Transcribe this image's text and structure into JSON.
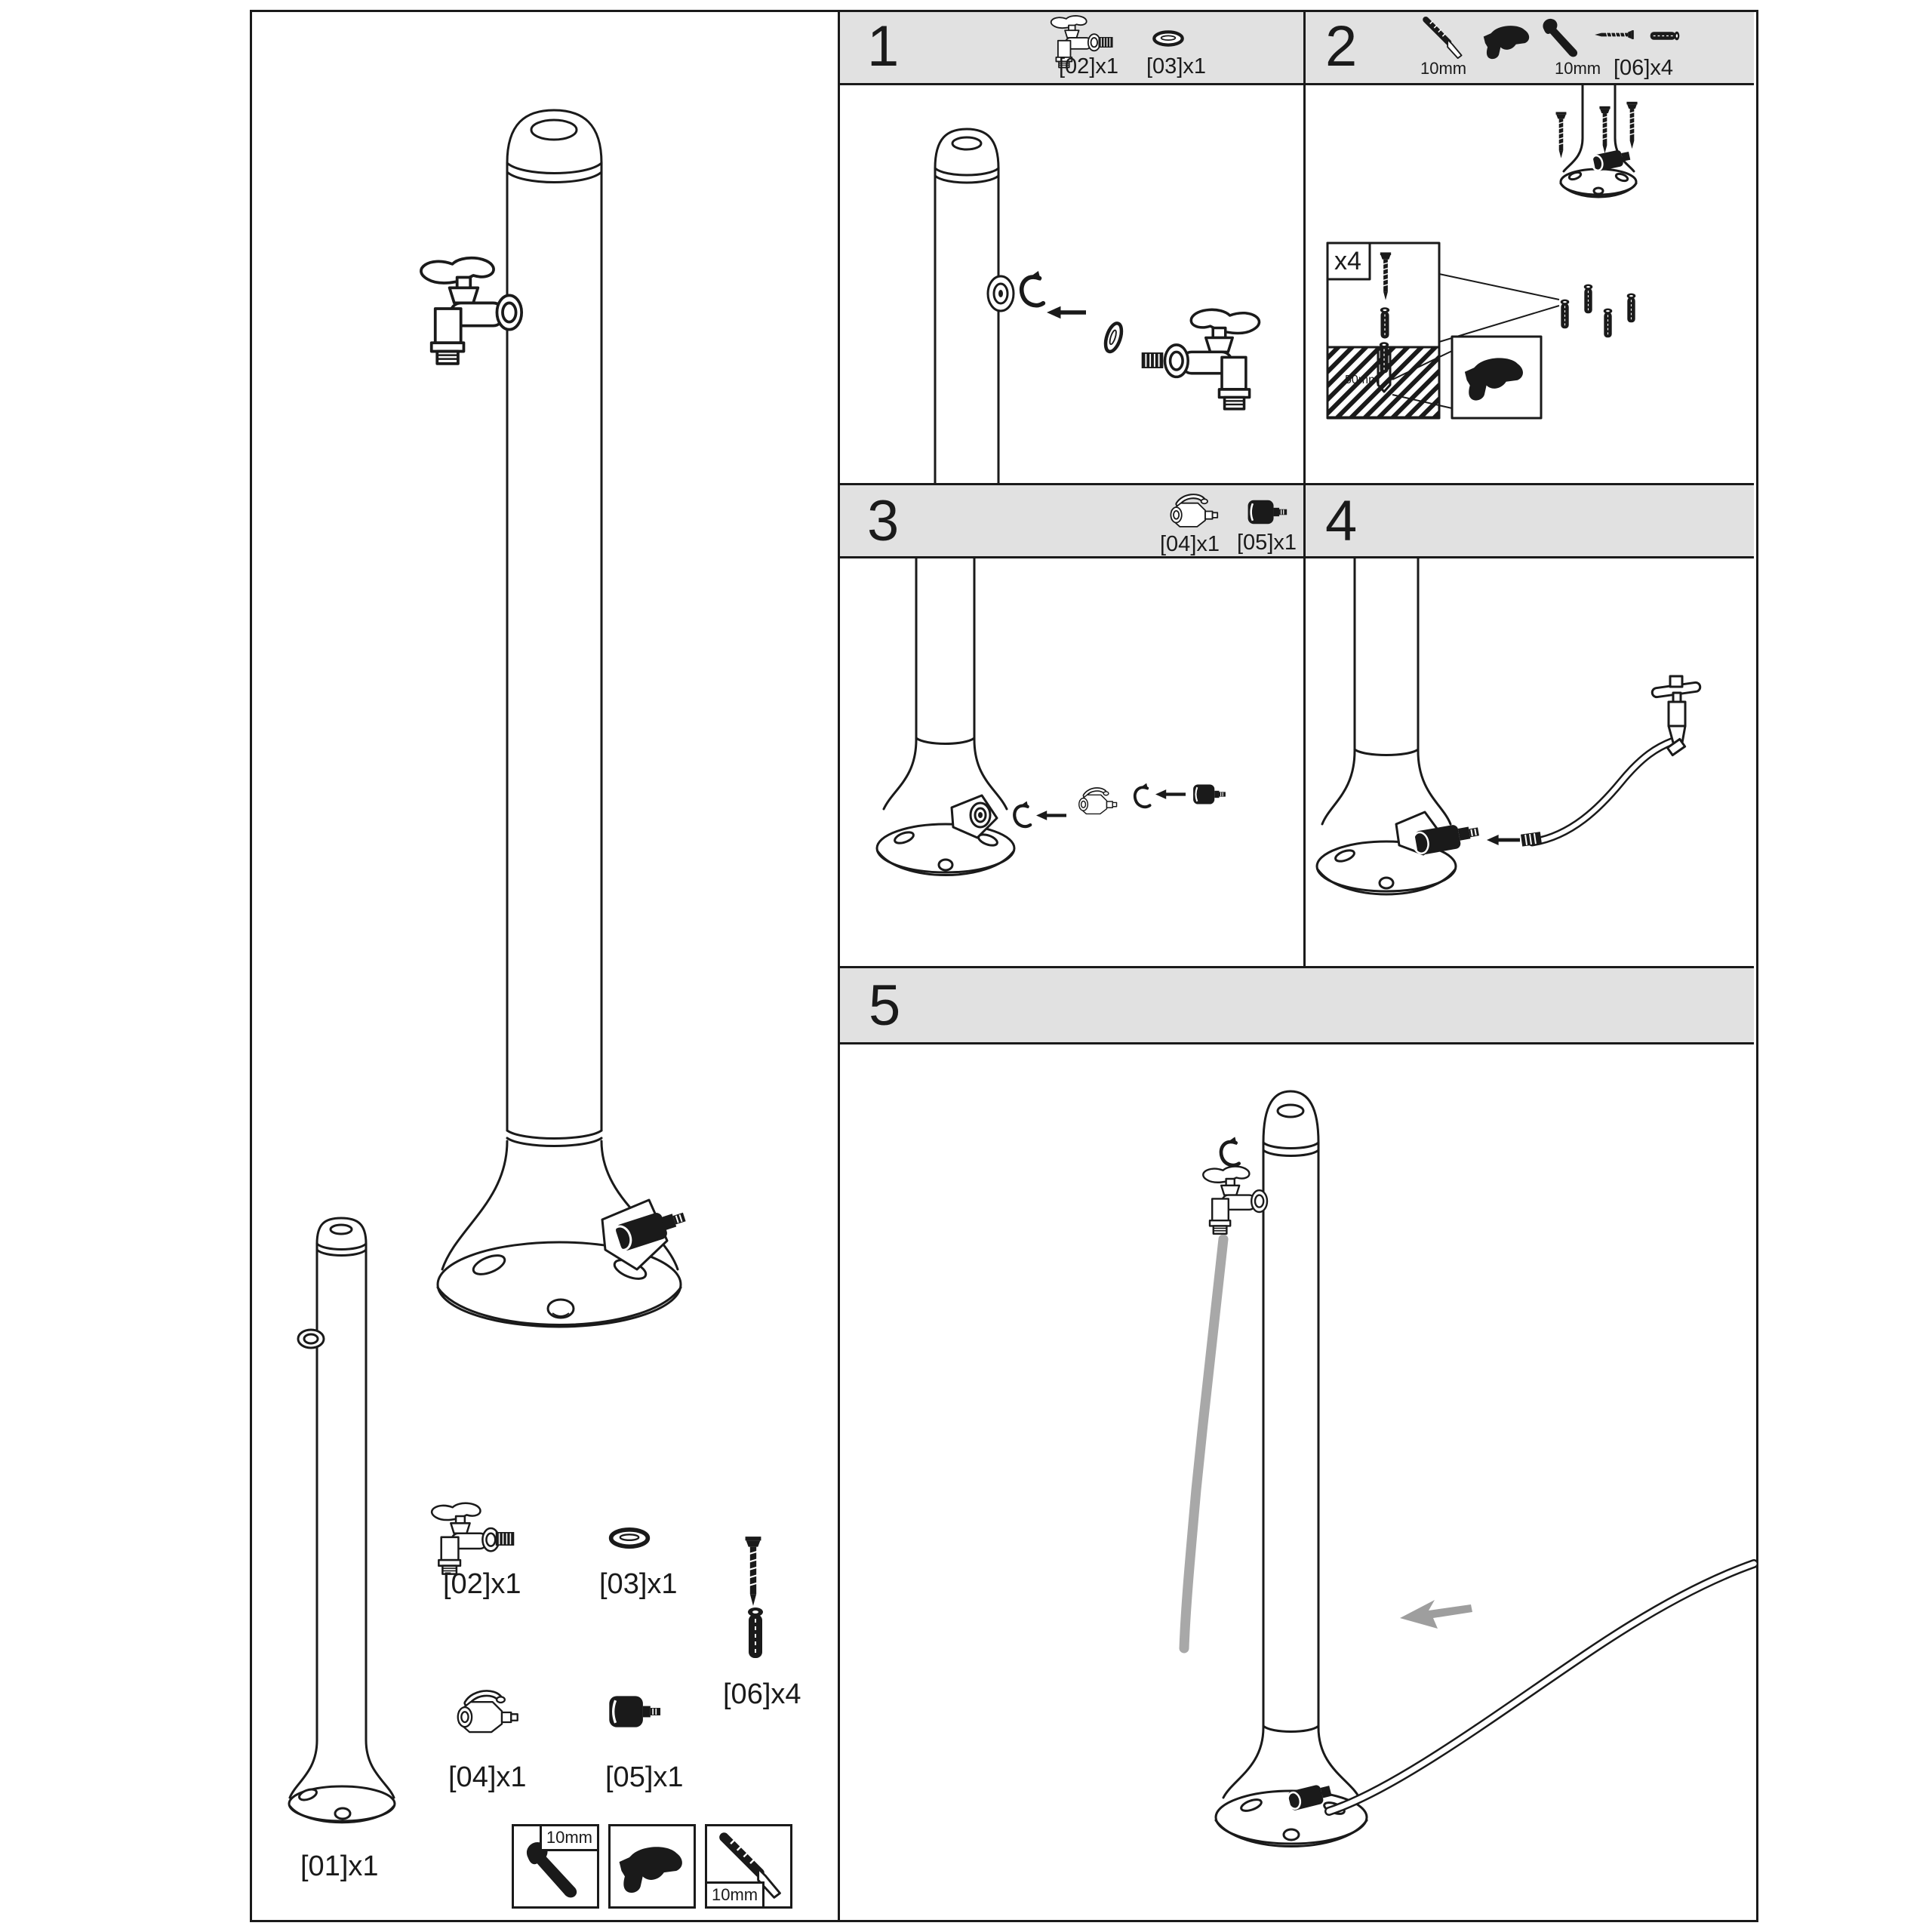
{
  "palette": {
    "ink": "#1a1a1a",
    "header_bg": "#e1e1e1",
    "water_gray": "#a8a8a8"
  },
  "kit": {
    "p01": "[01]x1",
    "p02": "[02]x1",
    "p03": "[03]x1",
    "p04": "[04]x1",
    "p05": "[05]x1",
    "p06": "[06]x4",
    "tool_wrench_size": "10mm",
    "tool_bit_size": "10mm"
  },
  "steps": {
    "s1": {
      "num": "1",
      "p02": "[02]x1",
      "p03": "[03]x1"
    },
    "s2": {
      "num": "2",
      "bit_size": "10mm",
      "wrench_size": "10mm",
      "p06": "[06]x4",
      "count": "x4",
      "depth": "50mm"
    },
    "s3": {
      "num": "3",
      "p04": "[04]x1",
      "p05": "[05]x1"
    },
    "s4": {
      "num": "4"
    },
    "s5": {
      "num": "5"
    }
  }
}
